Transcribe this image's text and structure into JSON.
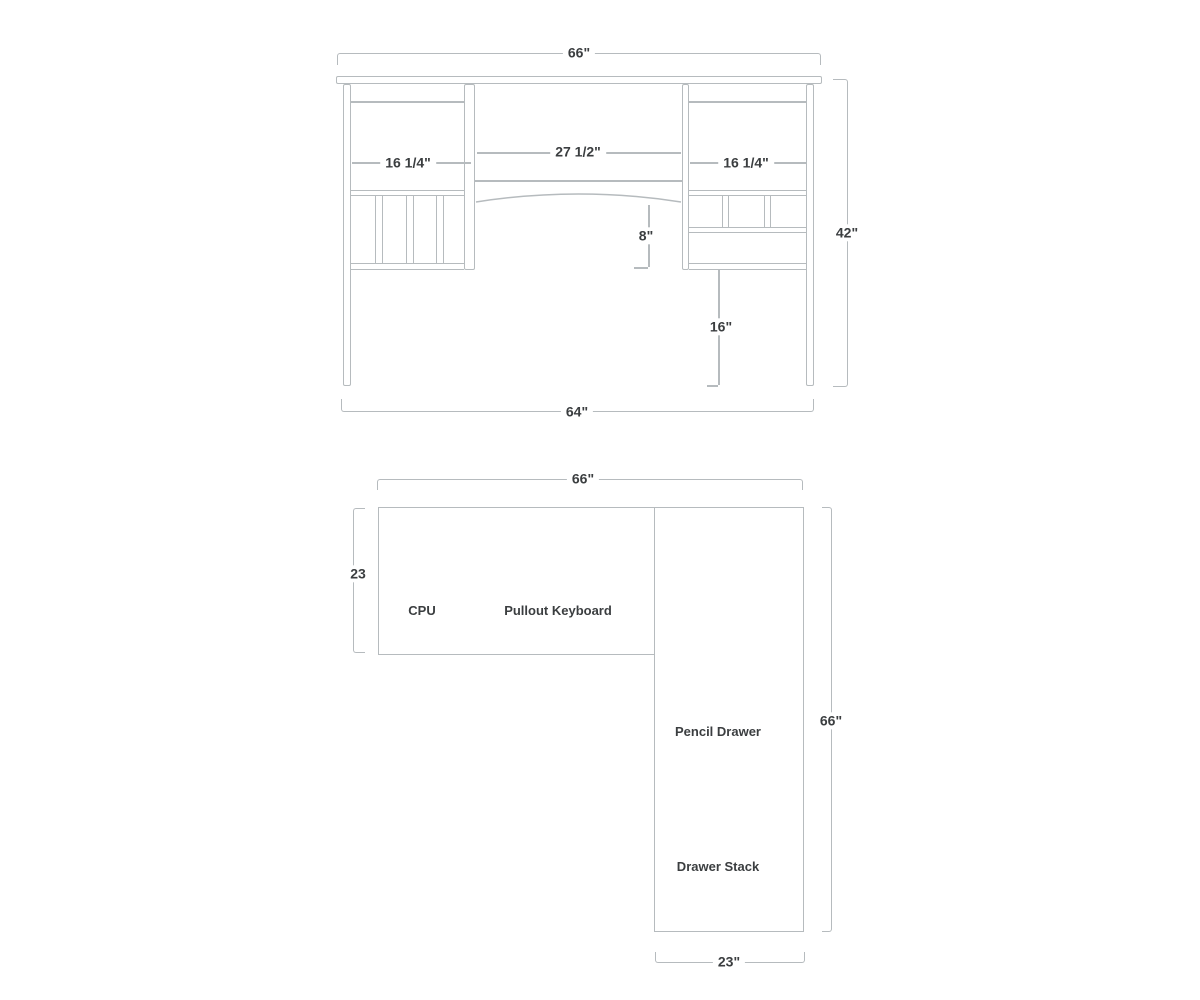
{
  "colors": {
    "line": "#b6bbbe",
    "text": "#3b3e40",
    "background": "#ffffff"
  },
  "front_view": {
    "dim_top_width": "66\"",
    "dim_left_opening": "16 1/4\"",
    "dim_center_opening": "27 1/2\"",
    "dim_right_opening": "16 1/4\"",
    "dim_apron_height": "8\"",
    "dim_overall_height": "42\"",
    "dim_knee_height": "16\"",
    "dim_base_width": "64\""
  },
  "plan_view": {
    "dim_top_width": "66\"",
    "dim_main_depth": "23",
    "dim_return_length": "66\"",
    "dim_return_depth": "23\"",
    "label_cpu": "CPU",
    "label_pullout_keyboard": "Pullout Keyboard",
    "label_pencil_drawer": "Pencil Drawer",
    "label_drawer_stack": "Drawer Stack"
  }
}
